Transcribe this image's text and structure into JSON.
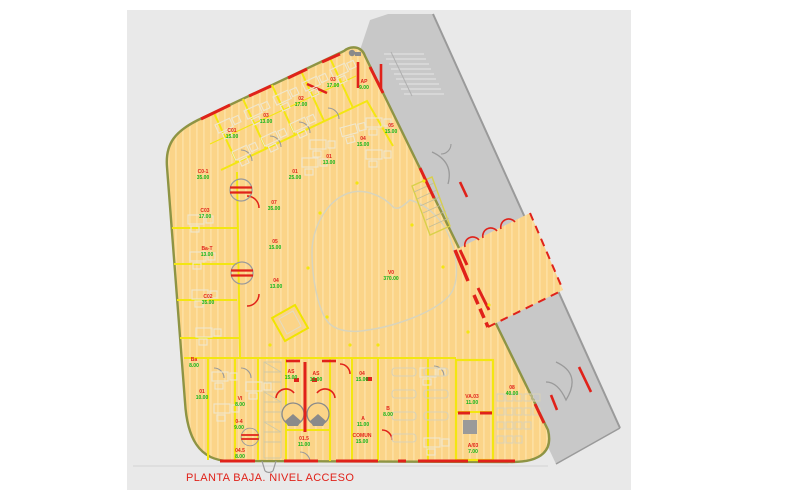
{
  "caption": "PLANTA BAJA. NIVEL ACCESO",
  "colors": {
    "paper": "#e9e9e9",
    "street": "#c8c8c8",
    "floor": "#fbd488",
    "floor_stripe": "#fddfa0",
    "partition_yellow": "#f3e611",
    "facade_olive": "#8e9444",
    "annotation_red": "#e0221a",
    "room_code_red": "#e0221a",
    "room_area_green": "#12b51a",
    "furniture_gray": "#efe7cf",
    "courtyard_outline": "#d8d4bd"
  },
  "rooms": [
    {
      "code": "03",
      "area": "17.00",
      "x": 333,
      "y": 81
    },
    {
      "code": "AP",
      "area": "9.00",
      "x": 364,
      "y": 83
    },
    {
      "code": "02",
      "area": "17.00",
      "x": 301,
      "y": 100
    },
    {
      "code": "03",
      "area": "13.00",
      "x": 266,
      "y": 117
    },
    {
      "code": "C01",
      "area": "15.00",
      "x": 232,
      "y": 132
    },
    {
      "code": "C0-1",
      "area": "35.00",
      "x": 203,
      "y": 173
    },
    {
      "code": "01",
      "area": "25.00",
      "x": 295,
      "y": 173
    },
    {
      "code": "01",
      "area": "13.00",
      "x": 329,
      "y": 158
    },
    {
      "code": "04",
      "area": "15.00",
      "x": 363,
      "y": 140
    },
    {
      "code": "05",
      "area": "15.00",
      "x": 391,
      "y": 127
    },
    {
      "code": "C03",
      "area": "17.00",
      "x": 205,
      "y": 212
    },
    {
      "code": "Ba-T",
      "area": "13.00",
      "x": 207,
      "y": 250
    },
    {
      "code": "C02",
      "area": "35.00",
      "x": 208,
      "y": 298
    },
    {
      "code": "07",
      "area": "35.00",
      "x": 274,
      "y": 204
    },
    {
      "code": "05",
      "area": "15.00",
      "x": 275,
      "y": 243
    },
    {
      "code": "04",
      "area": "13.00",
      "x": 276,
      "y": 282
    },
    {
      "code": "V0",
      "area": "370.00",
      "x": 391,
      "y": 274
    },
    {
      "code": "Ba",
      "area": "8.00",
      "x": 194,
      "y": 361
    },
    {
      "code": "01",
      "area": "10.00",
      "x": 202,
      "y": 393
    },
    {
      "code": "VI",
      "area": "8.00",
      "x": 240,
      "y": 400
    },
    {
      "code": "0-4",
      "area": "9.00",
      "x": 239,
      "y": 423
    },
    {
      "code": "04.5",
      "area": "8.00",
      "x": 240,
      "y": 452
    },
    {
      "code": "AS",
      "area": "15.00",
      "x": 291,
      "y": 373
    },
    {
      "code": "AS",
      "area": "15.00",
      "x": 316,
      "y": 375
    },
    {
      "code": "04",
      "area": "15.00",
      "x": 362,
      "y": 375
    },
    {
      "code": "A",
      "area": "11.00",
      "x": 363,
      "y": 420
    },
    {
      "code": "B",
      "area": "8.00",
      "x": 388,
      "y": 410
    },
    {
      "code": "01.5",
      "area": "11.00",
      "x": 304,
      "y": 440
    },
    {
      "code": "COMUN",
      "area": "15.00",
      "x": 362,
      "y": 437
    },
    {
      "code": "08",
      "area": "40.00",
      "x": 512,
      "y": 389
    },
    {
      "code": "VA.03",
      "area": "11.00",
      "x": 472,
      "y": 398
    },
    {
      "code": "A/03",
      "area": "7.00",
      "x": 473,
      "y": 447
    }
  ],
  "columns": [
    [
      357,
      183
    ],
    [
      320,
      213
    ],
    [
      412,
      225
    ],
    [
      443,
      267
    ],
    [
      308,
      268
    ],
    [
      327,
      317
    ],
    [
      378,
      345
    ],
    [
      468,
      332
    ],
    [
      424,
      181
    ],
    [
      489,
      305
    ],
    [
      350,
      345
    ],
    [
      270,
      345
    ]
  ]
}
